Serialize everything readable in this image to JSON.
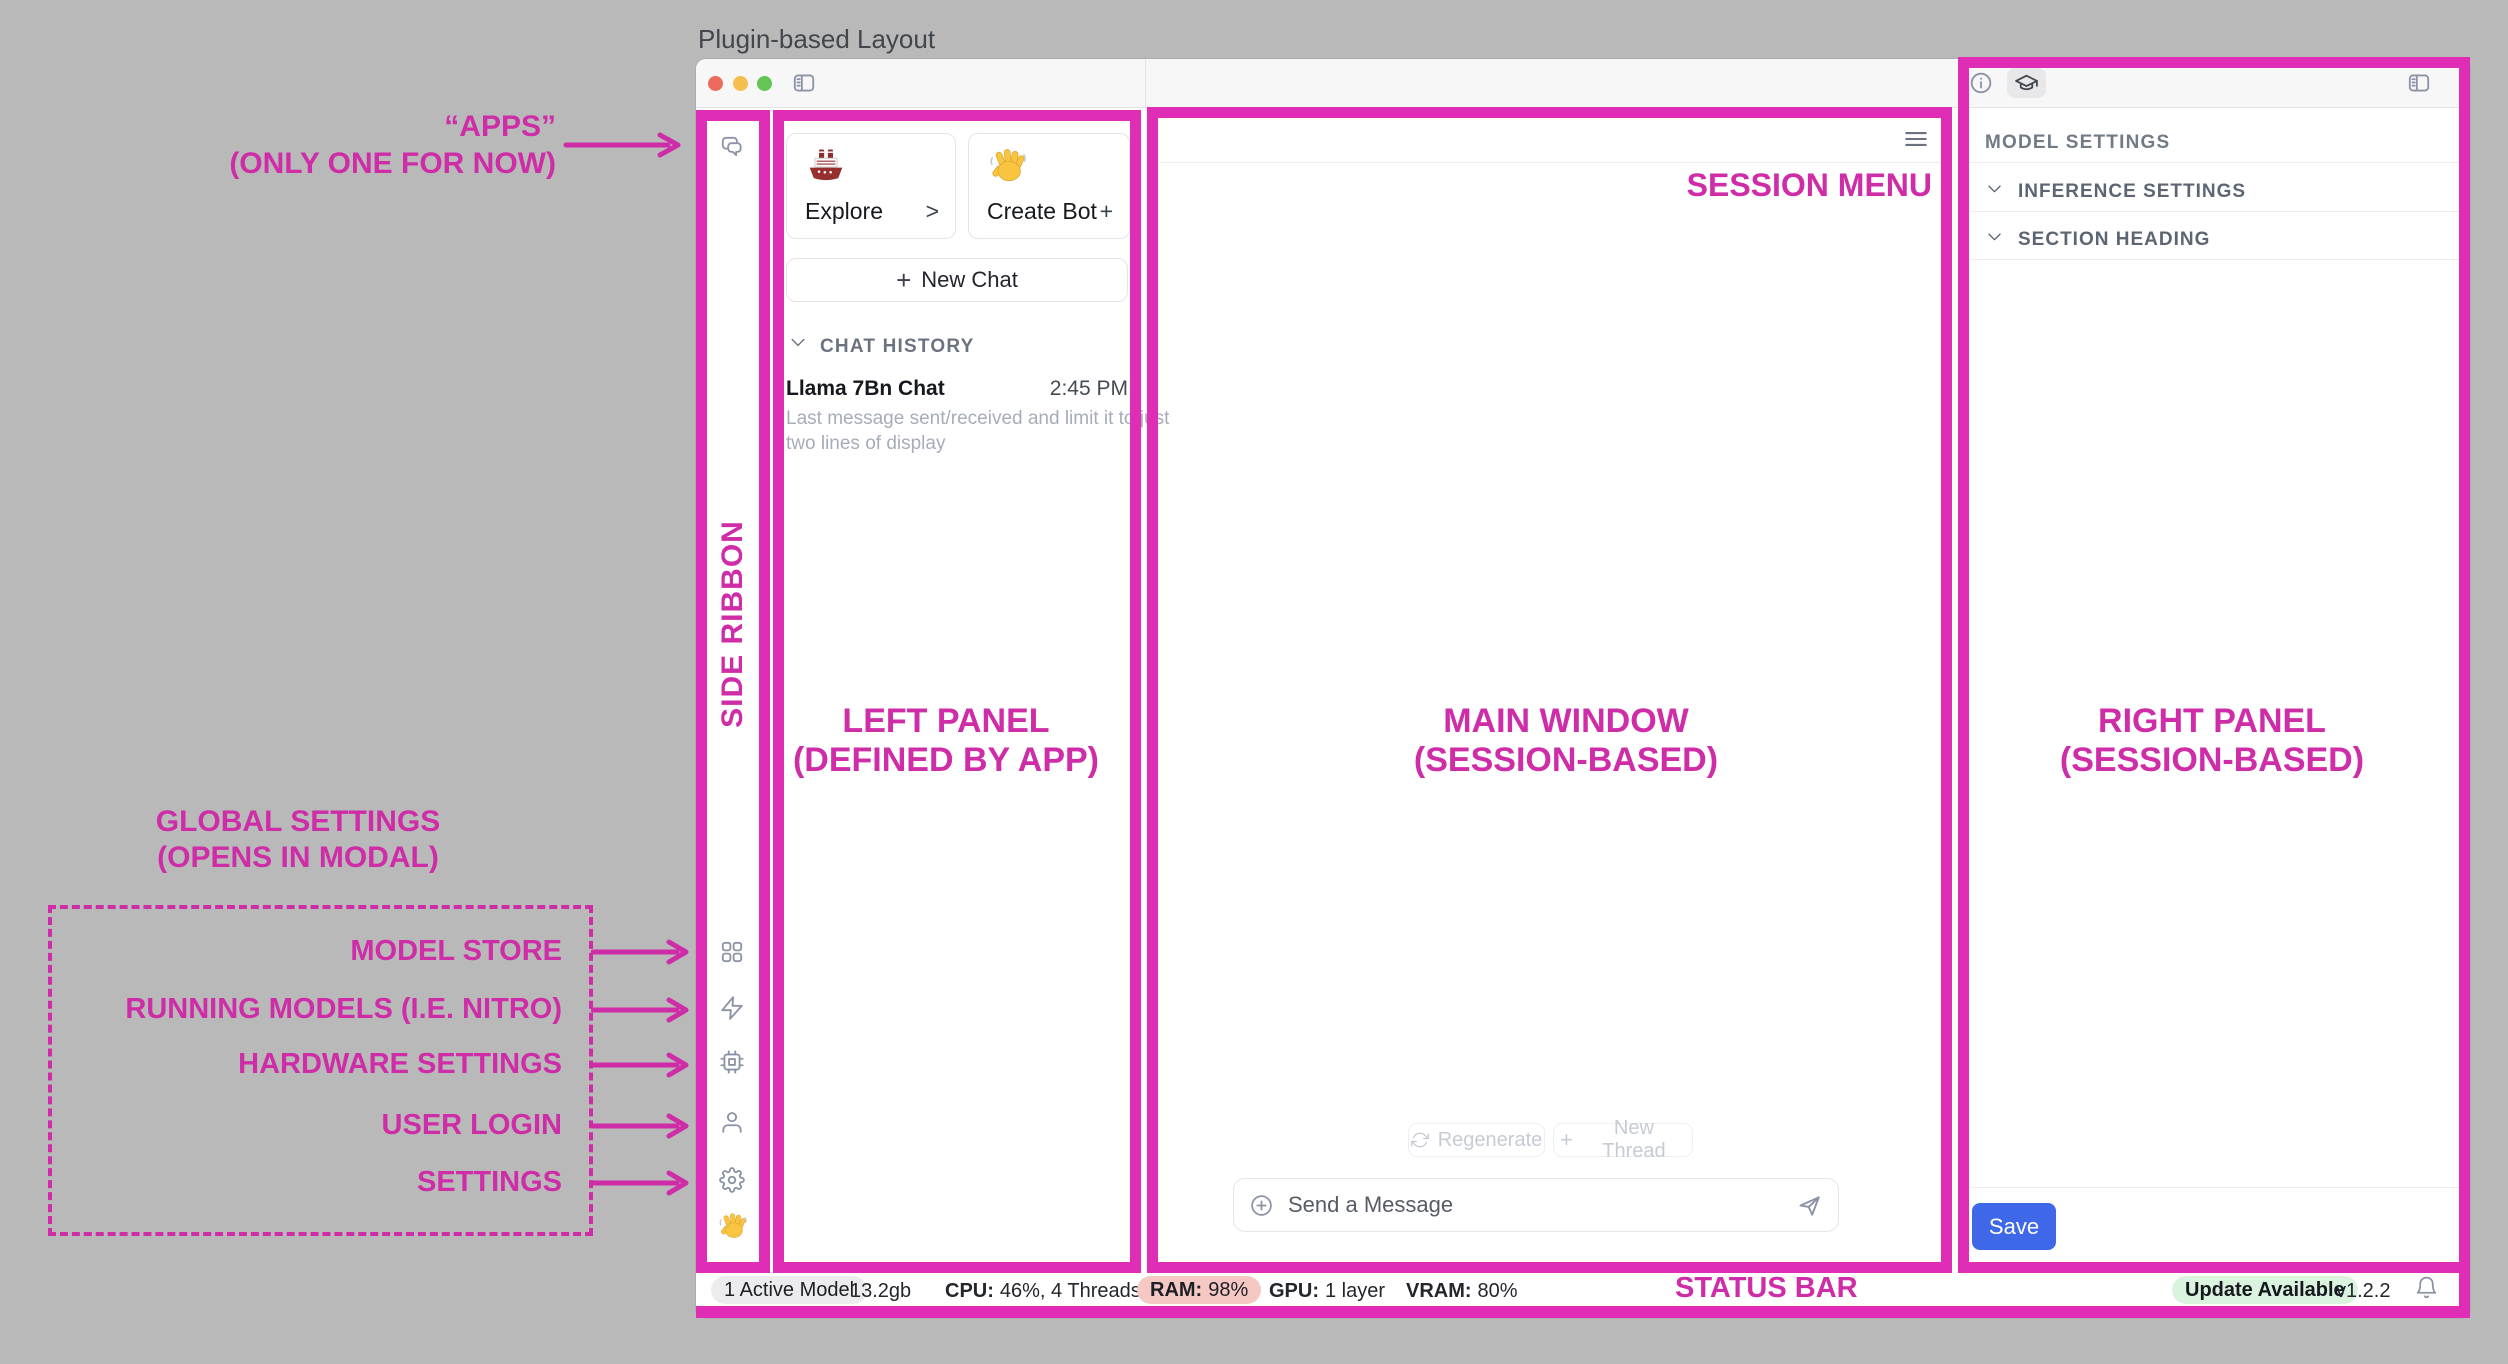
{
  "page_title": "Plugin-based Layout",
  "colors": {
    "annotation_pink_border": "#e02db6",
    "annotation_pink_text": "#cf2ca8",
    "save_button_blue": "#3f68e8",
    "ram_pill_bg": "#f6c8c4",
    "update_pill_bg": "#d9f3df",
    "traffic_red": "#ed6a5e",
    "traffic_yellow": "#f4bf4f",
    "traffic_green": "#62c554"
  },
  "icons": {
    "ribbon": [
      "chat-bubbles",
      "apps-grid",
      "lightning",
      "chip",
      "user",
      "gear",
      "wave-hand-emoji"
    ],
    "topbar": [
      "traffic-lights",
      "sidebar-toggle"
    ],
    "right_header": [
      "info",
      "graduation-cap",
      "sidebar-toggle"
    ],
    "statusbar": [
      "bell"
    ]
  },
  "left_panel": {
    "explore": {
      "label": "Explore",
      "action": ">",
      "emoji": "ship"
    },
    "create_bot": {
      "label": "Create Bot",
      "action": "+",
      "emoji": "wave-hand"
    },
    "new_chat_plus": "+",
    "new_chat": "New Chat",
    "chat_history_header": "CHAT HISTORY",
    "chat": {
      "title": "Llama 7Bn Chat",
      "time": "2:45 PM",
      "preview_line1": "Last message sent/received and limit it to just",
      "preview_line2": "two lines of display"
    }
  },
  "main": {
    "regenerate": "Regenerate",
    "new_thread_plus": "+",
    "new_thread": "New Thread",
    "message_placeholder": "Send a Message"
  },
  "right_panel": {
    "heading": "MODEL SETTINGS",
    "sections": [
      "INFERENCE SETTINGS",
      "SECTION HEADING"
    ],
    "save": "Save"
  },
  "status": {
    "active_model": "1 Active Model",
    "size": "13.2gb",
    "cpu_label": "CPU:",
    "cpu_value": "46%, 4 Threads",
    "ram_label": "RAM:",
    "ram_value": "98%",
    "gpu_label": "GPU:",
    "gpu_value": "1 layer",
    "vram_label": "VRAM:",
    "vram_value": "80%",
    "update_badge": "Update Available",
    "version": "v1.2.2"
  },
  "annotations": {
    "apps_line1": "“APPS”",
    "apps_line2": "(ONLY ONE FOR NOW)",
    "side_ribbon": "SIDE RIBBON",
    "left_panel_line1": "LEFT PANEL",
    "left_panel_line2": "(DEFINED BY APP)",
    "main_window_line1": "MAIN WINDOW",
    "main_window_line2": "(SESSION-BASED)",
    "right_panel_line1": "RIGHT PANEL",
    "right_panel_line2": "(SESSION-BASED)",
    "session_menu": "SESSION MENU",
    "status_bar": "STATUS BAR",
    "global_settings_line1": "GLOBAL SETTINGS",
    "global_settings_line2": "(OPENS IN MODAL)",
    "global_items": [
      "MODEL STORE",
      "RUNNING MODELS (I.E. NITRO)",
      "HARDWARE SETTINGS",
      "USER LOGIN",
      "SETTINGS"
    ]
  }
}
